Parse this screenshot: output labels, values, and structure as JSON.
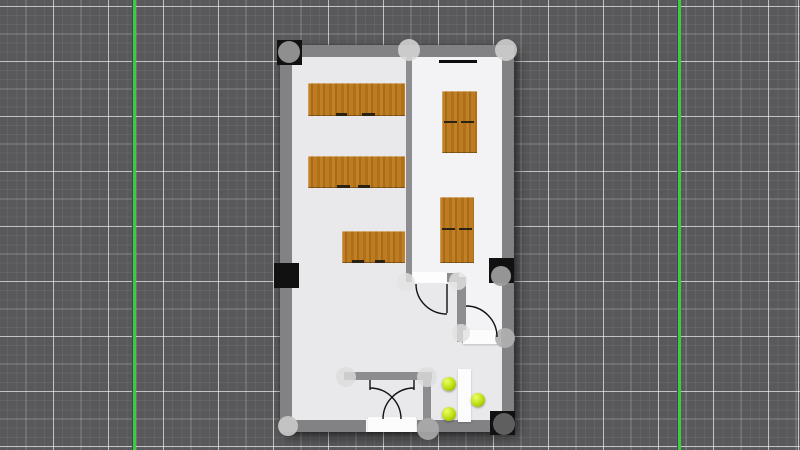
{
  "app": {
    "view": "floor-plan-editor-canvas"
  },
  "colors": {
    "canvas_bg": "#59595b",
    "guide_green": "#3ecb3e",
    "guide_edge": "#3c4660",
    "wall": "#828284",
    "wall_inner": "#8d8d8f",
    "floor_left": "#e9e9eb",
    "floor_right": "#f3f3f5",
    "wood": "#b5761f",
    "marker_black": "#111111",
    "chair_green": "#b8d90e",
    "white_item": "#fcfcfc",
    "arc_stroke": "#111111"
  },
  "guides": [
    {
      "x": 133
    },
    {
      "x": 678
    }
  ],
  "plan": {
    "outer": {
      "x": 280,
      "y": 45,
      "w": 234,
      "h": 387
    },
    "floors": [
      {
        "name": "room-floor-main",
        "x": 283,
        "y": 48,
        "w": 228,
        "h": 381,
        "shade": "left"
      },
      {
        "name": "room-floor-right",
        "x": 409,
        "y": 51,
        "w": 96,
        "h": 226,
        "shade": "right"
      },
      {
        "name": "room-floor-corridor",
        "x": 463,
        "y": 277,
        "w": 42,
        "h": 56,
        "shade": "right"
      }
    ],
    "walls": [
      {
        "name": "wall-top",
        "x": 280,
        "y": 45,
        "w": 234,
        "h": 12,
        "tone": "outer"
      },
      {
        "name": "wall-bottom",
        "x": 280,
        "y": 420,
        "w": 234,
        "h": 12,
        "tone": "outer"
      },
      {
        "name": "wall-left",
        "x": 280,
        "y": 45,
        "w": 12,
        "h": 387,
        "tone": "outer"
      },
      {
        "name": "wall-right",
        "x": 502,
        "y": 45,
        "w": 12,
        "h": 387,
        "tone": "outer"
      },
      {
        "name": "wall-divider",
        "x": 406,
        "y": 57,
        "w": 6,
        "h": 220,
        "tone": "inner"
      },
      {
        "name": "wall-room-bottom",
        "x": 406,
        "y": 273,
        "w": 53,
        "h": 9,
        "tone": "inner"
      },
      {
        "name": "wall-vestibule-vertical",
        "x": 457,
        "y": 277,
        "w": 9,
        "h": 65,
        "tone": "inner"
      },
      {
        "name": "wall-corridor-bottom",
        "x": 462,
        "y": 331,
        "w": 44,
        "h": 12,
        "tone": "inner"
      },
      {
        "name": "wall-entry-horizontal",
        "x": 344,
        "y": 372,
        "w": 88,
        "h": 8,
        "tone": "inner"
      },
      {
        "name": "wall-entry-vertical",
        "x": 423,
        "y": 372,
        "w": 8,
        "h": 54,
        "tone": "inner"
      }
    ],
    "openings": [
      {
        "name": "door-opening-interior",
        "x": 412,
        "y": 272,
        "w": 35,
        "h": 11
      },
      {
        "name": "door-opening-bottom-double",
        "x": 366,
        "y": 419,
        "w": 51,
        "h": 13
      }
    ],
    "tables": [
      {
        "name": "desk-row-1",
        "x": 308,
        "y": 83,
        "w": 97,
        "h": 33
      },
      {
        "name": "desk-row-2",
        "x": 308,
        "y": 156,
        "w": 97,
        "h": 32
      },
      {
        "name": "desk-row-3",
        "x": 342,
        "y": 231,
        "w": 63,
        "h": 32
      },
      {
        "name": "desk-right-1",
        "x": 442,
        "y": 91,
        "w": 35,
        "h": 62
      },
      {
        "name": "desk-right-2",
        "x": 440,
        "y": 197,
        "w": 34,
        "h": 66
      }
    ],
    "dashes": [
      {
        "x": 336,
        "y": 113,
        "w": 11,
        "h": 3
      },
      {
        "x": 362,
        "y": 113,
        "w": 13,
        "h": 3
      },
      {
        "x": 337,
        "y": 185,
        "w": 13,
        "h": 3
      },
      {
        "x": 358,
        "y": 185,
        "w": 12,
        "h": 3
      },
      {
        "x": 352,
        "y": 260,
        "w": 12,
        "h": 3
      },
      {
        "x": 375,
        "y": 260,
        "w": 10,
        "h": 3
      },
      {
        "x": 444,
        "y": 121,
        "w": 13,
        "h": 2
      },
      {
        "x": 461,
        "y": 121,
        "w": 13,
        "h": 2
      },
      {
        "x": 442,
        "y": 228,
        "w": 13,
        "h": 2
      },
      {
        "x": 459,
        "y": 228,
        "w": 13,
        "h": 2
      }
    ],
    "board": {
      "name": "wall-board",
      "x": 439,
      "y": 60,
      "w": 38,
      "h": 3
    },
    "white_items": [
      {
        "name": "double-door-panel",
        "x": 368,
        "y": 417,
        "w": 48,
        "h": 15
      },
      {
        "name": "corridor-door-panel",
        "x": 463,
        "y": 330,
        "w": 38,
        "h": 14
      },
      {
        "name": "side-table",
        "x": 458,
        "y": 369,
        "w": 13,
        "h": 53
      }
    ],
    "chairs": [
      {
        "name": "chair-sphere",
        "cx": 449,
        "cy": 384,
        "r": 7
      },
      {
        "name": "chair-sphere",
        "cx": 478,
        "cy": 400,
        "r": 7
      },
      {
        "name": "chair-sphere",
        "cx": 449,
        "cy": 414,
        "r": 7
      }
    ],
    "squares": [
      {
        "name": "corner-marker-top-left",
        "x": 277,
        "y": 40,
        "w": 25,
        "h": 25
      },
      {
        "name": "wall-marker-left",
        "x": 274,
        "y": 263,
        "w": 25,
        "h": 25
      },
      {
        "name": "wall-marker-right",
        "x": 489,
        "y": 258,
        "w": 25,
        "h": 25
      },
      {
        "name": "corner-marker-bottom-right",
        "x": 490,
        "y": 411,
        "w": 25,
        "h": 24
      }
    ],
    "handles": [
      {
        "name": "selection-handle",
        "cx": 289,
        "cy": 52,
        "r": 11,
        "fill": "#8f8f8f",
        "op": 1
      },
      {
        "name": "selection-handle",
        "cx": 409,
        "cy": 50,
        "r": 11,
        "fill": "#d8d8d8",
        "op": 0.85
      },
      {
        "name": "selection-handle",
        "cx": 506,
        "cy": 50,
        "r": 11,
        "fill": "#d4d4d4",
        "op": 0.85
      },
      {
        "name": "selection-handle",
        "cx": 501,
        "cy": 276,
        "r": 10,
        "fill": "#9d9d9d",
        "op": 0.95
      },
      {
        "name": "selection-handle",
        "cx": 504,
        "cy": 424,
        "r": 11,
        "fill": "#5f5f5f",
        "op": 1
      },
      {
        "name": "selection-handle",
        "cx": 288,
        "cy": 426,
        "r": 10,
        "fill": "#c6c6c6",
        "op": 0.95
      },
      {
        "name": "selection-handle",
        "cx": 428,
        "cy": 429,
        "r": 11,
        "fill": "#ababab",
        "op": 0.9
      },
      {
        "name": "selection-handle",
        "cx": 346,
        "cy": 377,
        "r": 10,
        "fill": "#dcdcdc",
        "op": 0.8
      },
      {
        "name": "selection-handle",
        "cx": 427,
        "cy": 377,
        "r": 10,
        "fill": "#dcdcdc",
        "op": 0.8
      },
      {
        "name": "selection-handle",
        "cx": 406,
        "cy": 282,
        "r": 9,
        "fill": "#e2e2e2",
        "op": 0.8
      },
      {
        "name": "selection-handle",
        "cx": 458,
        "cy": 281,
        "r": 9,
        "fill": "#e2e2e2",
        "op": 0.8
      },
      {
        "name": "selection-handle",
        "cx": 461,
        "cy": 333,
        "r": 9,
        "fill": "#e0e0e0",
        "op": 0.8
      },
      {
        "name": "selection-handle",
        "cx": 505,
        "cy": 338,
        "r": 10,
        "fill": "#b0b0b0",
        "op": 0.9
      }
    ],
    "arcs": [
      {
        "name": "door-swing-arc",
        "d": "M 416 284 A 31 30 0 0 0 447 314"
      },
      {
        "name": "door-panel-line",
        "d": "M 447 284 L 447 313"
      },
      {
        "name": "door-swing-arc",
        "d": "M 466 306 A 31 31 0 0 1 497 337"
      },
      {
        "name": "door-panel-tick",
        "d": "M 370 380 L 370 390"
      },
      {
        "name": "door-swing-arc",
        "d": "M 370 388 A 31 31 0 0 1 401 419"
      },
      {
        "name": "door-panel-tick",
        "d": "M 414 380 L 414 390"
      },
      {
        "name": "door-swing-arc",
        "d": "M 414 388 A 31 31 0 0 0 383 419"
      }
    ]
  }
}
